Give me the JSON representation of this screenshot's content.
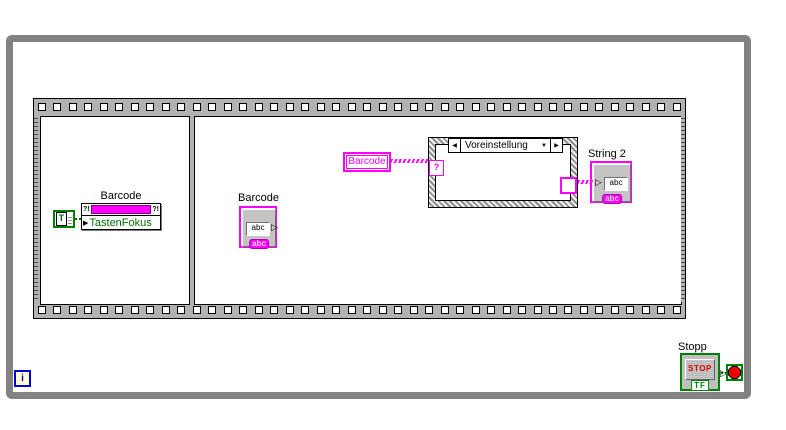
{
  "frame1": {
    "property_node": {
      "label": "Barcode",
      "property": "TastenFokus",
      "glyph_left": "?!",
      "glyph_right": "?!"
    },
    "true_constant": {
      "value": "T"
    }
  },
  "frame2": {
    "string_control": {
      "label": "Barcode",
      "field_text": "abc",
      "type_tag": "abc"
    },
    "local_variable": {
      "label": "Barcode"
    },
    "case_structure": {
      "selector_value": "Voreinstellung",
      "selector_terminal": "?",
      "nav_left": "◀",
      "nav_right": "▶",
      "dropdown": "▼"
    },
    "string_indicator": {
      "label": "String 2",
      "field_text": "abc",
      "type_tag": "abc"
    }
  },
  "while_loop": {
    "iteration_terminal": "i",
    "stop_button": {
      "label": "Stopp",
      "text": "STOP",
      "boolean_tag": "TF"
    }
  },
  "glyphs": {
    "input_arrow": "▶",
    "output_arrow": "▷"
  },
  "colors": {
    "string_pink": "#ff00ff",
    "boolean_green": "#008000",
    "stop_red": "#cc0000",
    "loop_gray": "#828282",
    "sequence_gray": "#b2b2b2"
  }
}
